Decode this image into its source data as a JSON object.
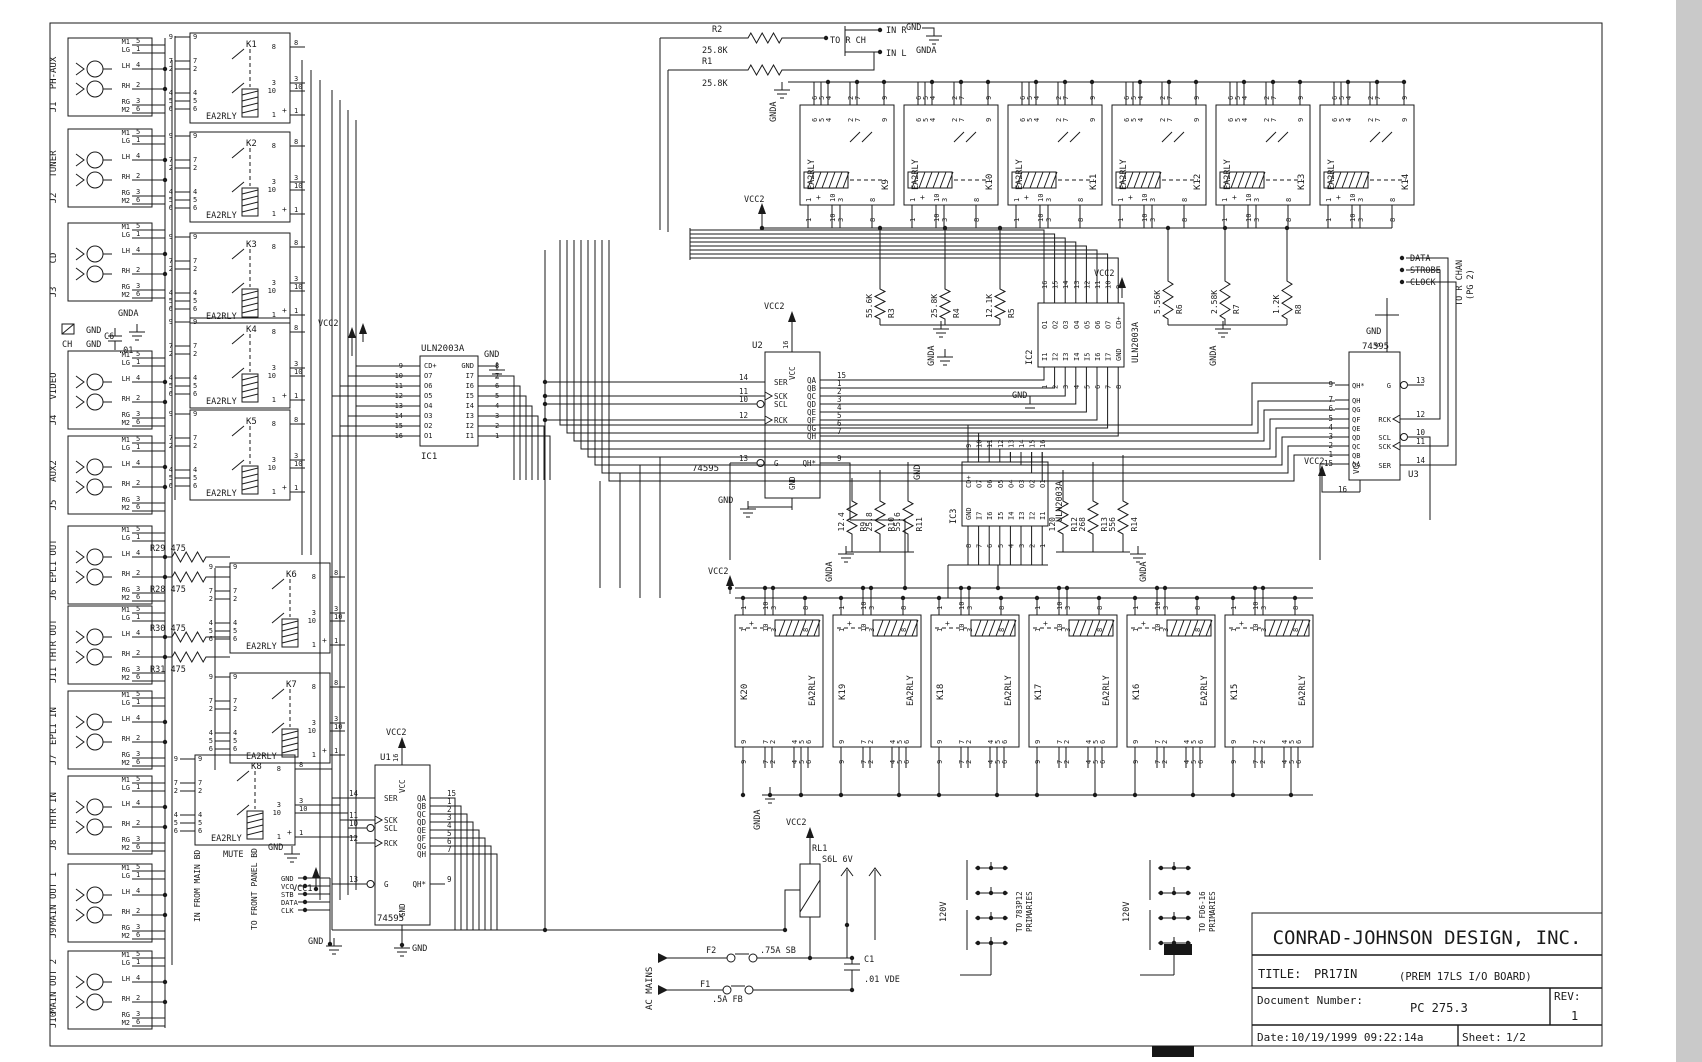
{
  "sheet": {
    "bg": "#ffffff",
    "ink": "#1a1a1a",
    "margin": "#c9c9c9"
  },
  "title_block": {
    "company": "CONRAD-JOHNSON DESIGN, INC.",
    "title_label": "TITLE:",
    "title": "PR17IN",
    "subtitle": "(PREM 17LS I/O BOARD)",
    "doc_label": "Document Number:",
    "doc_number": "PC 275.3",
    "rev_label": "REV:",
    "rev": "1",
    "date_label": "Date:",
    "date": "10/19/1999 09:22:14a",
    "sheet_label": "Sheet:",
    "sheet_num": "1/2"
  },
  "jacks": {
    "pin_names": [
      "M1",
      "LG",
      "LH",
      "RH",
      "RG",
      "M2"
    ],
    "pin_numbers": [
      "5",
      "1",
      "4",
      "2",
      "3",
      "6"
    ],
    "items": [
      {
        "ref": "J1",
        "label": "PH-AUX",
        "yc": 77
      },
      {
        "ref": "J2",
        "label": "TUNER",
        "yc": 168
      },
      {
        "ref": "J3",
        "label": "CD",
        "yc": 262
      },
      {
        "ref": "J4",
        "label": "VIDEO",
        "yc": 390
      },
      {
        "ref": "J5",
        "label": "AUX2",
        "yc": 475
      },
      {
        "ref": "J6",
        "label": "EPL1 OUT",
        "yc": 565
      },
      {
        "ref": "J11",
        "label": "THTR OUT",
        "yc": 645
      },
      {
        "ref": "J7",
        "label": "EPL1 IN",
        "yc": 730
      },
      {
        "ref": "J8",
        "label": "THTR IN",
        "yc": 815
      },
      {
        "ref": "J9",
        "label": "MAIN OUT 1",
        "yc": 903
      },
      {
        "ref": "J10",
        "label": "MAIN OUT 2",
        "yc": 990
      }
    ]
  },
  "relays": {
    "part": "EA2RLY",
    "pin_sets": {
      "v_left": [
        "9",
        "7",
        "2",
        "4",
        "5",
        "6"
      ],
      "v_right": [
        "8",
        "3",
        "10",
        "1"
      ],
      "h_top": [
        "6",
        "5",
        "4",
        "2",
        "7",
        "9"
      ],
      "h_bottom": [
        "1",
        "10",
        "3",
        "8"
      ]
    },
    "vertical": [
      {
        "ref": "K1",
        "x": 190,
        "y": 33
      },
      {
        "ref": "K2",
        "x": 190,
        "y": 132
      },
      {
        "ref": "K3",
        "x": 190,
        "y": 233
      },
      {
        "ref": "K4",
        "x": 190,
        "y": 318
      },
      {
        "ref": "K5",
        "x": 190,
        "y": 410
      },
      {
        "ref": "K6",
        "x": 230,
        "y": 563
      },
      {
        "ref": "K7",
        "x": 230,
        "y": 673
      },
      {
        "ref": "K8",
        "x": 195,
        "y": 755,
        "note": "MUTE"
      }
    ],
    "top_row": {
      "refs": [
        "K9",
        "K10",
        "K11",
        "K12",
        "K13",
        "K14"
      ],
      "xs": [
        800,
        904,
        1008,
        1112,
        1216,
        1320
      ]
    },
    "bottom_row": {
      "refs": [
        "K20",
        "K19",
        "K18",
        "K17",
        "K16",
        "K15"
      ],
      "xs": [
        735,
        833,
        931,
        1029,
        1127,
        1225
      ]
    }
  },
  "ics": [
    {
      "ref": "IC1",
      "part": "ULN2003A",
      "type": "vdip",
      "x": 420,
      "y": 356,
      "w": 58,
      "h": 90,
      "left_labels": [
        "CD+",
        "O7",
        "O6",
        "O5",
        "O4",
        "O3",
        "O2",
        "O1"
      ],
      "left_nums": [
        "9",
        "10",
        "11",
        "12",
        "13",
        "14",
        "15",
        "16"
      ],
      "right_labels": [
        "GND",
        "I7",
        "I6",
        "I5",
        "I4",
        "I3",
        "I2",
        "I1"
      ],
      "right_nums": [
        "8",
        "7",
        "6",
        "5",
        "4",
        "3",
        "2",
        "1"
      ]
    },
    {
      "ref": "IC2",
      "part": "ULN2003A",
      "type": "hdip",
      "x": 1038,
      "y": 303,
      "w": 86,
      "h": 64,
      "top_labels": [
        "O1",
        "O2",
        "O3",
        "O4",
        "O5",
        "O6",
        "O7",
        "CD+"
      ],
      "top_nums": [
        "16",
        "15",
        "14",
        "13",
        "12",
        "11",
        "10",
        "9"
      ],
      "bottom_labels": [
        "I1",
        "I2",
        "I3",
        "I4",
        "I5",
        "I6",
        "I7",
        "GND"
      ],
      "bottom_nums": [
        "1",
        "2",
        "3",
        "4",
        "5",
        "6",
        "7",
        "8"
      ]
    },
    {
      "ref": "IC3",
      "part": "ULN2003A",
      "type": "hdip",
      "x": 962,
      "y": 462,
      "w": 86,
      "h": 64,
      "top_labels": [
        "CD+",
        "O7",
        "O6",
        "O5",
        "O4",
        "O3",
        "O2",
        "O1"
      ],
      "top_nums": [
        "9",
        "10",
        "11",
        "12",
        "13",
        "14",
        "15",
        "16"
      ],
      "bottom_labels": [
        "GND",
        "I7",
        "I6",
        "I5",
        "I4",
        "I3",
        "I2",
        "I1"
      ],
      "bottom_nums": [
        "8",
        "7",
        "6",
        "5",
        "4",
        "3",
        "2",
        "1"
      ]
    }
  ],
  "registers": [
    {
      "ref": "U1",
      "part": "74595",
      "x": 375,
      "y": 765,
      "w": 55,
      "h": 160,
      "vcc": "VCC",
      "gnd": "GND",
      "pin16": "16",
      "refAt": [
        380,
        760
      ],
      "partAt": [
        377,
        921
      ],
      "left": [
        {
          "n": "14",
          "l": "SER",
          "y": 798
        },
        {
          "n": "11",
          "l": "SCK",
          "y": 820,
          "clk": true
        },
        {
          "n": "10",
          "l": "SCL",
          "y": 828,
          "bub": true
        },
        {
          "n": "12",
          "l": "RCK",
          "y": 843,
          "clk": true
        },
        {
          "n": "13",
          "l": "G",
          "y": 884,
          "bub": true
        }
      ],
      "right": [
        {
          "n": "15",
          "l": "QA",
          "y": 798
        },
        {
          "n": "1",
          "l": "QB",
          "y": 806
        },
        {
          "n": "2",
          "l": "QC",
          "y": 814
        },
        {
          "n": "3",
          "l": "QD",
          "y": 822
        },
        {
          "n": "4",
          "l": "QE",
          "y": 830
        },
        {
          "n": "5",
          "l": "QF",
          "y": 838
        },
        {
          "n": "6",
          "l": "QG",
          "y": 846
        },
        {
          "n": "7",
          "l": "QH",
          "y": 854
        },
        {
          "n": "9",
          "l": "QH*",
          "y": 884
        }
      ]
    },
    {
      "ref": "U2",
      "part": "74595",
      "x": 765,
      "y": 352,
      "w": 55,
      "h": 146,
      "vcc": "VCC",
      "gnd": "GND",
      "pin16": "16",
      "refAt": [
        752,
        348
      ],
      "partAt": [
        692,
        471
      ],
      "left": [
        {
          "n": "14",
          "l": "SER",
          "y": 382
        },
        {
          "n": "11",
          "l": "SCK",
          "y": 396,
          "clk": true
        },
        {
          "n": "10",
          "l": "SCL",
          "y": 404,
          "bub": true
        },
        {
          "n": "12",
          "l": "RCK",
          "y": 420,
          "clk": true
        },
        {
          "n": "13",
          "l": "G",
          "y": 463,
          "bub": true
        }
      ],
      "right": [
        {
          "n": "15",
          "l": "QA",
          "y": 380
        },
        {
          "n": "1",
          "l": "QB",
          "y": 388
        },
        {
          "n": "2",
          "l": "QC",
          "y": 396
        },
        {
          "n": "3",
          "l": "QD",
          "y": 404
        },
        {
          "n": "4",
          "l": "QE",
          "y": 412
        },
        {
          "n": "5",
          "l": "QF",
          "y": 420
        },
        {
          "n": "6",
          "l": "QG",
          "y": 428
        },
        {
          "n": "7",
          "l": "QH",
          "y": 436
        },
        {
          "n": "9",
          "l": "QH*",
          "y": 463
        }
      ]
    },
    {
      "ref": "U3",
      "part": "74595",
      "x": 1349,
      "y": 352,
      "w": 51,
      "h": 128,
      "mir": true,
      "vcc": "VCC",
      "gnd": "GND",
      "pin16": "16",
      "pin8": "8",
      "gnd_top": "GND",
      "refAt": [
        1408,
        477
      ],
      "partAt": [
        1362,
        349
      ],
      "right": [
        {
          "n": "13",
          "l": "G",
          "y": 385,
          "bub": true
        },
        {
          "n": "12",
          "l": "RCK",
          "y": 419,
          "clk": true
        },
        {
          "n": "10",
          "l": "SCL",
          "y": 437,
          "bub": true
        },
        {
          "n": "11",
          "l": "SCK",
          "y": 446,
          "clk": true
        },
        {
          "n": "14",
          "l": "SER",
          "y": 465
        }
      ],
      "left": [
        {
          "n": "9",
          "l": "QH*",
          "y": 385
        },
        {
          "n": "7",
          "l": "QH",
          "y": 400
        },
        {
          "n": "6",
          "l": "QG",
          "y": 409
        },
        {
          "n": "5",
          "l": "QF",
          "y": 419
        },
        {
          "n": "4",
          "l": "QE",
          "y": 428
        },
        {
          "n": "3",
          "l": "QD",
          "y": 437
        },
        {
          "n": "2",
          "l": "QC",
          "y": 446
        },
        {
          "n": "1",
          "l": "QB",
          "y": 455
        },
        {
          "n": "15",
          "l": "QA",
          "y": 464
        }
      ]
    }
  ],
  "resistors": [
    {
      "ref": "R2",
      "value": "25.8K",
      "o": "h",
      "x1": 742,
      "x2": 788,
      "y": 38,
      "refAt": [
        712,
        32
      ],
      "valAt": [
        702,
        53
      ]
    },
    {
      "ref": "R1",
      "value": "25.8K",
      "o": "h",
      "x1": 742,
      "x2": 788,
      "y": 70,
      "refAt": [
        702,
        64
      ],
      "valAt": [
        702,
        86
      ]
    },
    {
      "ref": "R3",
      "value": "55.6K",
      "o": "v",
      "x": 880,
      "y1": 283,
      "y2": 325
    },
    {
      "ref": "R4",
      "value": "25.8K",
      "o": "v",
      "x": 945,
      "y1": 283,
      "y2": 325
    },
    {
      "ref": "R5",
      "value": "12.1K",
      "o": "v",
      "x": 1000,
      "y1": 283,
      "y2": 325
    },
    {
      "ref": "R6",
      "value": "5.56K",
      "o": "v",
      "x": 1168,
      "y1": 275,
      "y2": 325
    },
    {
      "ref": "R7",
      "value": "2.58K",
      "o": "v",
      "x": 1225,
      "y1": 275,
      "y2": 325
    },
    {
      "ref": "R8",
      "value": "1.2K",
      "o": "v",
      "x": 1287,
      "y1": 275,
      "y2": 325
    },
    {
      "ref": "R9",
      "value": "12.4",
      "o": "v",
      "x": 852,
      "y1": 495,
      "y2": 540
    },
    {
      "ref": "R10",
      "value": "25.8",
      "o": "v",
      "x": 880,
      "y1": 495,
      "y2": 540
    },
    {
      "ref": "R11",
      "value": "55.6",
      "o": "v",
      "x": 908,
      "y1": 495,
      "y2": 540
    },
    {
      "ref": "R12",
      "value": "120",
      "o": "v",
      "x": 1063,
      "y1": 495,
      "y2": 540
    },
    {
      "ref": "R13",
      "value": "268",
      "o": "v",
      "x": 1093,
      "y1": 495,
      "y2": 540
    },
    {
      "ref": "R14",
      "value": "556",
      "o": "v",
      "x": 1123,
      "y1": 495,
      "y2": 540
    },
    {
      "ref": "R29",
      "value": "475",
      "o": "h",
      "x1": 166,
      "x2": 212,
      "y": 557,
      "refAt": [
        150,
        551
      ]
    },
    {
      "ref": "R28",
      "value": "475",
      "o": "h",
      "x1": 166,
      "x2": 212,
      "y": 577,
      "refAt": [
        150,
        592
      ]
    },
    {
      "ref": "R30",
      "value": "475",
      "o": "h",
      "x1": 166,
      "x2": 212,
      "y": 637,
      "refAt": [
        150,
        631
      ]
    },
    {
      "ref": "R31",
      "value": "475",
      "o": "h",
      "x1": 166,
      "x2": 212,
      "y": 657,
      "refAt": [
        150,
        672
      ]
    }
  ],
  "power": {
    "rl1_ref": "RL1",
    "rl1_part": "S6L 6V",
    "f2_ref": "F2",
    "f2_value": ".75A SB",
    "f1_ref": "F1",
    "f1_value": ".5A FB",
    "c1_ref": "C1",
    "c1_value": ".01 VDE",
    "ac": "AC MAINS",
    "xf1_v": "120V",
    "xf1_dest": "TO 783P12",
    "xf1_dest2": "PRIMARIES",
    "xf2_v": "120V",
    "xf2_dest": "TO FD6-16",
    "xf2_dest2": "PRIMARIES"
  },
  "labels": [
    {
      "t": "TO R CH",
      "x": 830,
      "y": 43
    },
    {
      "t": "IN R",
      "x": 886,
      "y": 33
    },
    {
      "t": "IN L",
      "x": 886,
      "y": 56
    },
    {
      "t": "GND",
      "x": 906,
      "y": 30
    },
    {
      "t": "GNDA",
      "x": 916,
      "y": 53
    },
    {
      "t": "GNDA",
      "x": 776,
      "y": 122,
      "r": -90
    },
    {
      "t": "VCC2",
      "x": 744,
      "y": 202
    },
    {
      "t": "VCC2",
      "x": 318,
      "y": 326
    },
    {
      "t": "GND",
      "x": 86,
      "y": 333
    },
    {
      "t": "CH",
      "x": 62,
      "y": 347
    },
    {
      "t": "GND",
      "x": 86,
      "y": 347
    },
    {
      "t": "C6",
      "x": 104,
      "y": 339
    },
    {
      "t": ".01",
      "x": 118,
      "y": 353
    },
    {
      "t": "GNDA",
      "x": 118,
      "y": 316
    },
    {
      "t": "GND",
      "x": 484,
      "y": 357
    },
    {
      "t": "VCC2",
      "x": 386,
      "y": 735
    },
    {
      "t": "VCC1",
      "x": 292,
      "y": 891
    },
    {
      "t": "GND",
      "x": 268,
      "y": 850
    },
    {
      "t": "TO FRONT PANEL BD",
      "x": 257,
      "y": 930,
      "r": -90,
      "s": 8
    },
    {
      "t": "IN FROM MAIN BD",
      "x": 200,
      "y": 922,
      "r": -90,
      "s": 8
    },
    {
      "t": "GND",
      "x": 281,
      "y": 881,
      "s": 7
    },
    {
      "t": "VCC",
      "x": 281,
      "y": 889,
      "s": 7
    },
    {
      "t": "STB",
      "x": 281,
      "y": 897,
      "s": 7
    },
    {
      "t": "DATA",
      "x": 281,
      "y": 905,
      "s": 7
    },
    {
      "t": "CLK",
      "x": 281,
      "y": 913,
      "s": 7
    },
    {
      "t": "GND",
      "x": 308,
      "y": 944
    },
    {
      "t": "GND",
      "x": 412,
      "y": 951
    },
    {
      "t": "VCC2",
      "x": 764,
      "y": 309
    },
    {
      "t": "GND",
      "x": 718,
      "y": 503
    },
    {
      "t": "GND",
      "x": 1012,
      "y": 398
    },
    {
      "t": "VCC2",
      "x": 1094,
      "y": 276
    },
    {
      "t": "GNDA",
      "x": 934,
      "y": 366,
      "r": -90
    },
    {
      "t": "GNDA",
      "x": 1216,
      "y": 366,
      "r": -90
    },
    {
      "t": "VCC2",
      "x": 708,
      "y": 574
    },
    {
      "t": "GNDA",
      "x": 760,
      "y": 830,
      "r": -90
    },
    {
      "t": "GND",
      "x": 920,
      "y": 480,
      "r": -90
    },
    {
      "t": "GNDA",
      "x": 832,
      "y": 582,
      "r": -90
    },
    {
      "t": "GNDA",
      "x": 1146,
      "y": 582,
      "r": -90
    },
    {
      "t": "VCC2",
      "x": 786,
      "y": 825
    },
    {
      "t": "DATA",
      "x": 1410,
      "y": 261
    },
    {
      "t": "STROBE",
      "x": 1410,
      "y": 273
    },
    {
      "t": "CLOCK",
      "x": 1410,
      "y": 285
    },
    {
      "t": "TO R CHAN",
      "x": 1462,
      "y": 306,
      "r": -90
    },
    {
      "t": "(PG 2)",
      "x": 1473,
      "y": 300,
      "r": -90
    },
    {
      "t": "VCC2",
      "x": 1304,
      "y": 464
    }
  ]
}
